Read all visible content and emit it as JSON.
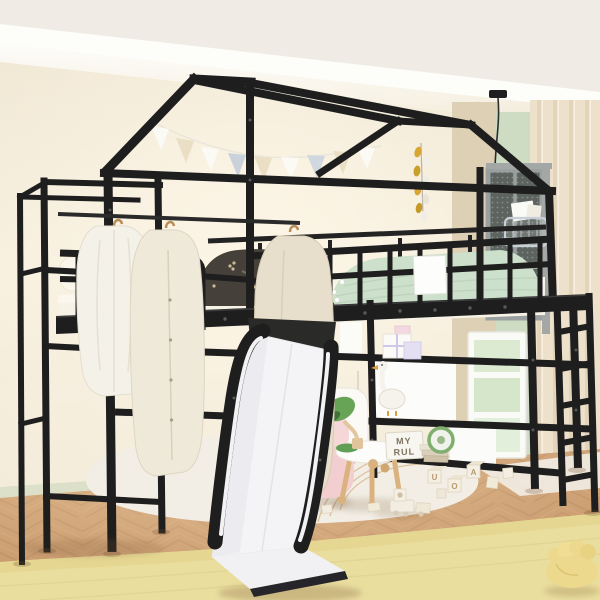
{
  "scene": {
    "subject": "Black metal house-frame twin loft bed with white slide, clothing rack, storage shelves and ladder in a pastel kids room"
  },
  "colors": {
    "frame": "#1e1e1e",
    "slide": "#f4f4f6",
    "wall": "#f1e8d6",
    "ceiling": "#f0ece5",
    "molding": "#fdfdfa",
    "floor": "#c8996c",
    "rugYellow": "#eade9f",
    "rugWhite": "#f2eee5",
    "sofa": "#f6d7d8",
    "curtain": "#f1e8d3",
    "greenWall": "#cddcc3",
    "beigePanel": "#ddd0b4",
    "sage": "#cde0cb",
    "pillowPink": "#c27681",
    "duvet": "#46403a",
    "pennant": "#e6b33c",
    "lampGreen": "#68a455",
    "wood": "#d9b27e",
    "mattress": "#f7f2e6",
    "clothesWhite": "#f4f1e9",
    "clothesCream": "#efe9da",
    "clothesGreige": "#e7dfcc"
  },
  "letter_board": {
    "line1": "MY",
    "line2": "RUL"
  },
  "toy_blocks": {
    "letters": [
      "U",
      "O",
      "A"
    ]
  },
  "bunting": {
    "flag_colors": [
      "#fbfaf4",
      "#eadfc4",
      "#fbfaf4",
      "#c9d2da",
      "#eadfc4",
      "#fbfaf4",
      "#cfd8de",
      "#eadfc4",
      "#fbfaf4"
    ]
  }
}
